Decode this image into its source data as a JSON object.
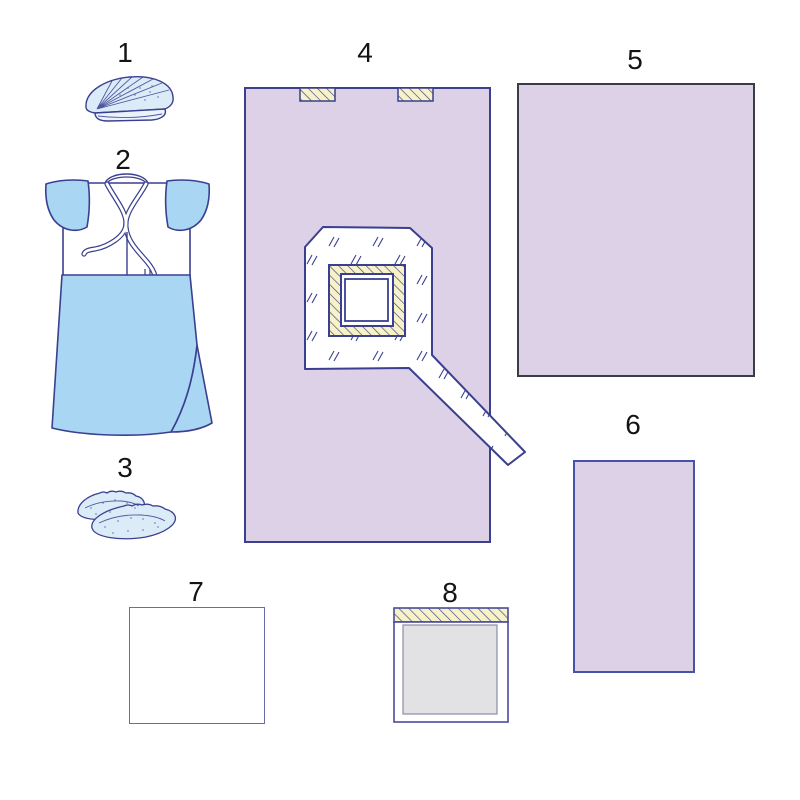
{
  "diagram": {
    "kind": "surgical-pack-contents-diagram",
    "background": "#ffffff"
  },
  "palette": {
    "lavender_drape": "#ddd1e8",
    "navy_outline": "#3a3f8f",
    "sky_blue": "#a9d6f3",
    "pale_blue": "#dcebf8",
    "pale_yellow_adhesive": "#f7f3c6",
    "light_gray_pad": "#e2e2e4",
    "dark_border": "#3c3c46",
    "label_color": "#141414"
  },
  "items": [
    {
      "number": "1",
      "name": "bouffant-cap"
    },
    {
      "number": "2",
      "name": "surgical-gown"
    },
    {
      "number": "3",
      "name": "shoe-covers"
    },
    {
      "number": "4",
      "name": "fenestrated-drape-with-adhesive-tabs-and-tail"
    },
    {
      "number": "5",
      "name": "large-drape-sheet"
    },
    {
      "number": "6",
      "name": "small-drape-sheet"
    },
    {
      "number": "7",
      "name": "white-sheet"
    },
    {
      "number": "8",
      "name": "adhesive-absorbent-pad"
    }
  ]
}
